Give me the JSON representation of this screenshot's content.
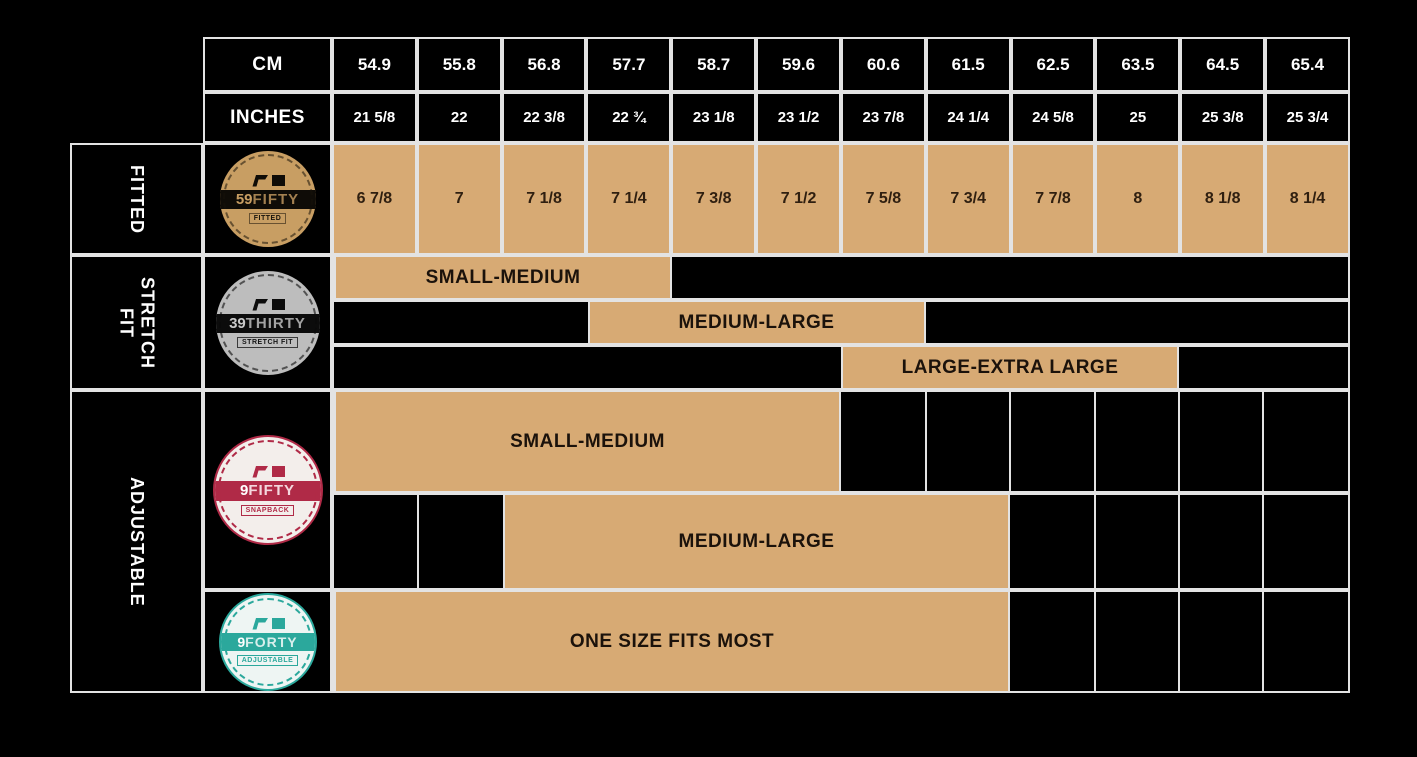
{
  "colors": {
    "tan": "#d7aa74",
    "gold": "#c89e63",
    "silver": "#bdbdbd",
    "crimson": "#b02a47",
    "teal": "#2ba89c",
    "line": "#e3e3e3"
  },
  "header": {
    "cm_label": "CM",
    "inches_label": "INCHES"
  },
  "side_labels": {
    "fitted": "FITTED",
    "stretch_line1": "STRETCH",
    "stretch_line2": "FIT",
    "adjustable": "ADJUSTABLE"
  },
  "logos": {
    "fiftynine": {
      "number": "59",
      "name": "FIFTY",
      "sub": "FITTED"
    },
    "thirtynine": {
      "number": "39",
      "name": "THIRTY",
      "sub": "STRETCH FIT"
    },
    "ninefifty": {
      "number": "9",
      "name": "FIFTY",
      "sub": "SNAPBACK"
    },
    "nineforty": {
      "number": "9",
      "name": "FORTY",
      "sub": "ADJUSTABLE"
    }
  },
  "chart_data": {
    "type": "table",
    "cm": [
      54.9,
      55.8,
      56.8,
      57.7,
      58.7,
      59.6,
      60.6,
      61.5,
      62.5,
      63.5,
      64.5,
      65.4
    ],
    "inches": [
      "21 5/8",
      "22",
      "22 3/8",
      "22 ¾",
      "23 1/8",
      "23 1/2",
      "23 7/8",
      "24 1/4",
      "24 5/8",
      "25",
      "25 3/8",
      "25 3/4"
    ],
    "rows": [
      {
        "section": "FITTED",
        "product": "59FIFTY",
        "fit_type": "FITTED",
        "sizes": [
          "6 7/8",
          "7",
          "7 1/8",
          "7 1/4",
          "7 3/8",
          "7 1/2",
          "7 5/8",
          "7 3/4",
          "7 7/8",
          "8",
          "8 1/8",
          "8 1/4"
        ]
      },
      {
        "section": "STRETCH FIT",
        "product": "39THIRTY",
        "fit_type": "STRETCH FIT",
        "bands": [
          {
            "label": "SMALL-MEDIUM",
            "start_col": 1,
            "end_col": 4,
            "cm_range": [
              54.9,
              57.7
            ]
          },
          {
            "label": "MEDIUM-LARGE",
            "start_col": 4,
            "end_col": 7,
            "cm_range": [
              57.7,
              60.6
            ]
          },
          {
            "label": "LARGE-EXTRA LARGE",
            "start_col": 7,
            "end_col": 10,
            "cm_range": [
              60.6,
              63.5
            ]
          }
        ]
      },
      {
        "section": "ADJUSTABLE",
        "product": "9FIFTY",
        "fit_type": "SNAPBACK",
        "bands": [
          {
            "label": "SMALL-MEDIUM",
            "start_col": 1,
            "end_col": 6,
            "cm_range": [
              54.9,
              59.6
            ]
          },
          {
            "label": "MEDIUM-LARGE",
            "start_col": 3,
            "end_col": 8,
            "cm_range": [
              56.8,
              61.5
            ]
          }
        ]
      },
      {
        "section": "ADJUSTABLE",
        "product": "9FORTY",
        "fit_type": "ADJUSTABLE",
        "bands": [
          {
            "label": "ONE SIZE FITS MOST",
            "start_col": 1,
            "end_col": 8,
            "cm_range": [
              54.9,
              61.5
            ]
          }
        ]
      }
    ]
  }
}
